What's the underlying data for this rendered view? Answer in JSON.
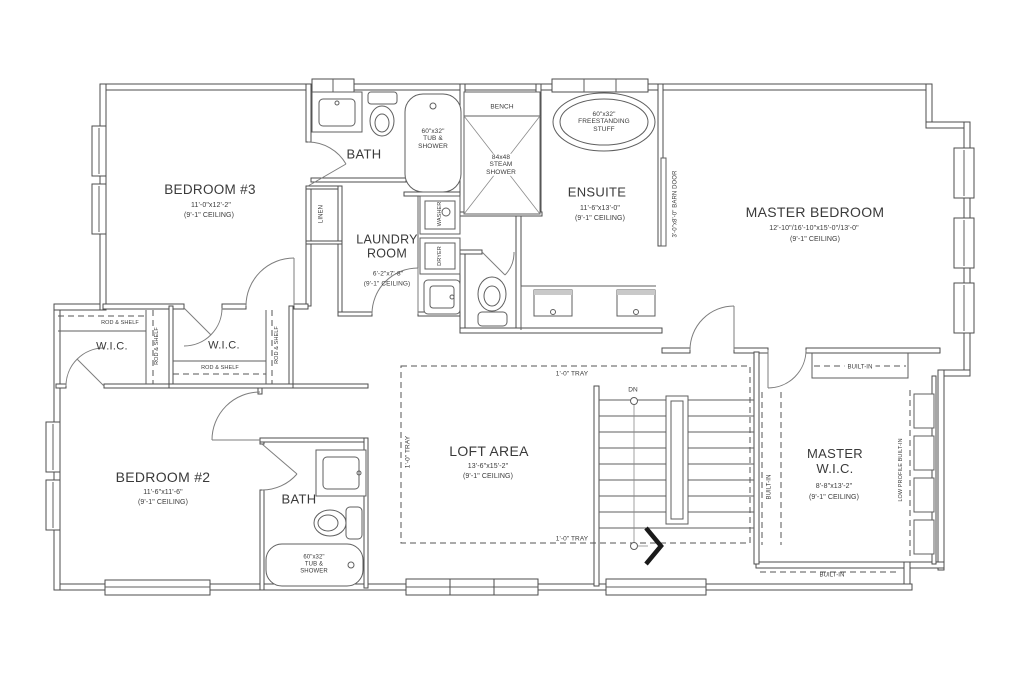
{
  "drawing": {
    "background": "#ffffff",
    "line_color": "#4e4e4e",
    "text_color": "#3a3a3a",
    "accent_arrow_color": "#1a1a1a"
  },
  "rooms": {
    "bedroom3": {
      "name": "BEDROOM #3",
      "dims": "11'-0\"x12'-2\"",
      "ceiling": "(9'-1\" CEILING)"
    },
    "bath_upper": {
      "name": "BATH",
      "tub": "60\"x32\"\nTUB &\nSHOWER"
    },
    "laundry": {
      "name": "LAUNDRY\nROOM",
      "dims": "6'-2\"x7'-8\"",
      "ceiling": "(9'-1\" CEILING)",
      "washer": "WASHER",
      "dryer": "DRYER",
      "linen": "LINEN"
    },
    "steam_shower": {
      "bench": "BENCH",
      "label": "84x48\nSTEAM\nSHOWER"
    },
    "ensuite": {
      "name": "ENSUITE",
      "dims": "11'-6\"x13'-0\"",
      "ceiling": "(9'-1\" CEILING)",
      "tub": "60\"x32\"\nFREESTANDING\nSTUFF",
      "barn_door": "3'-0\"x8'-0\" BARN DOOR"
    },
    "master_bedroom": {
      "name": "MASTER BEDROOM",
      "dims": "12'-10\"/16'-10\"x15'-0\"/13'-0\"",
      "ceiling": "(9'-1\" CEILING)"
    },
    "wic_left": {
      "name": "W.I.C.",
      "rod_shelf_top": "ROD & SHELF",
      "rod_shelf_side": "ROD & SHELF"
    },
    "wic_right": {
      "name": "W.I.C.",
      "rod_shelf_bottom": "ROD & SHELF",
      "rod_shelf_side": "ROD & SHELF"
    },
    "bedroom2": {
      "name": "BEDROOM #2",
      "dims": "11'-6\"x11'-6\"",
      "ceiling": "(9'-1\" CEILING)"
    },
    "bath_lower": {
      "name": "BATH",
      "tub": "60\"x32\"\nTUB &\nSHOWER"
    },
    "loft": {
      "name": "LOFT AREA",
      "dims": "13'-6\"x15'-2\"",
      "ceiling": "(9'-1\" CEILING)",
      "tray_top": "1'-0\" TRAY",
      "tray_bottom": "1'-0\" TRAY",
      "tray_left": "1'-0\" TRAY"
    },
    "stairs": {
      "down": "DN"
    },
    "master_wic": {
      "name": "MASTER\nW.I.C.",
      "dims": "8'-8\"x13'-2\"",
      "ceiling": "(9'-1\" CEILING)",
      "builtin_top": "BUILT-IN",
      "builtin_left": "BUILT-IN",
      "builtin_bottom": "BUILT-IN",
      "low_profile": "LOW PROFILE BUILT-IN"
    }
  }
}
